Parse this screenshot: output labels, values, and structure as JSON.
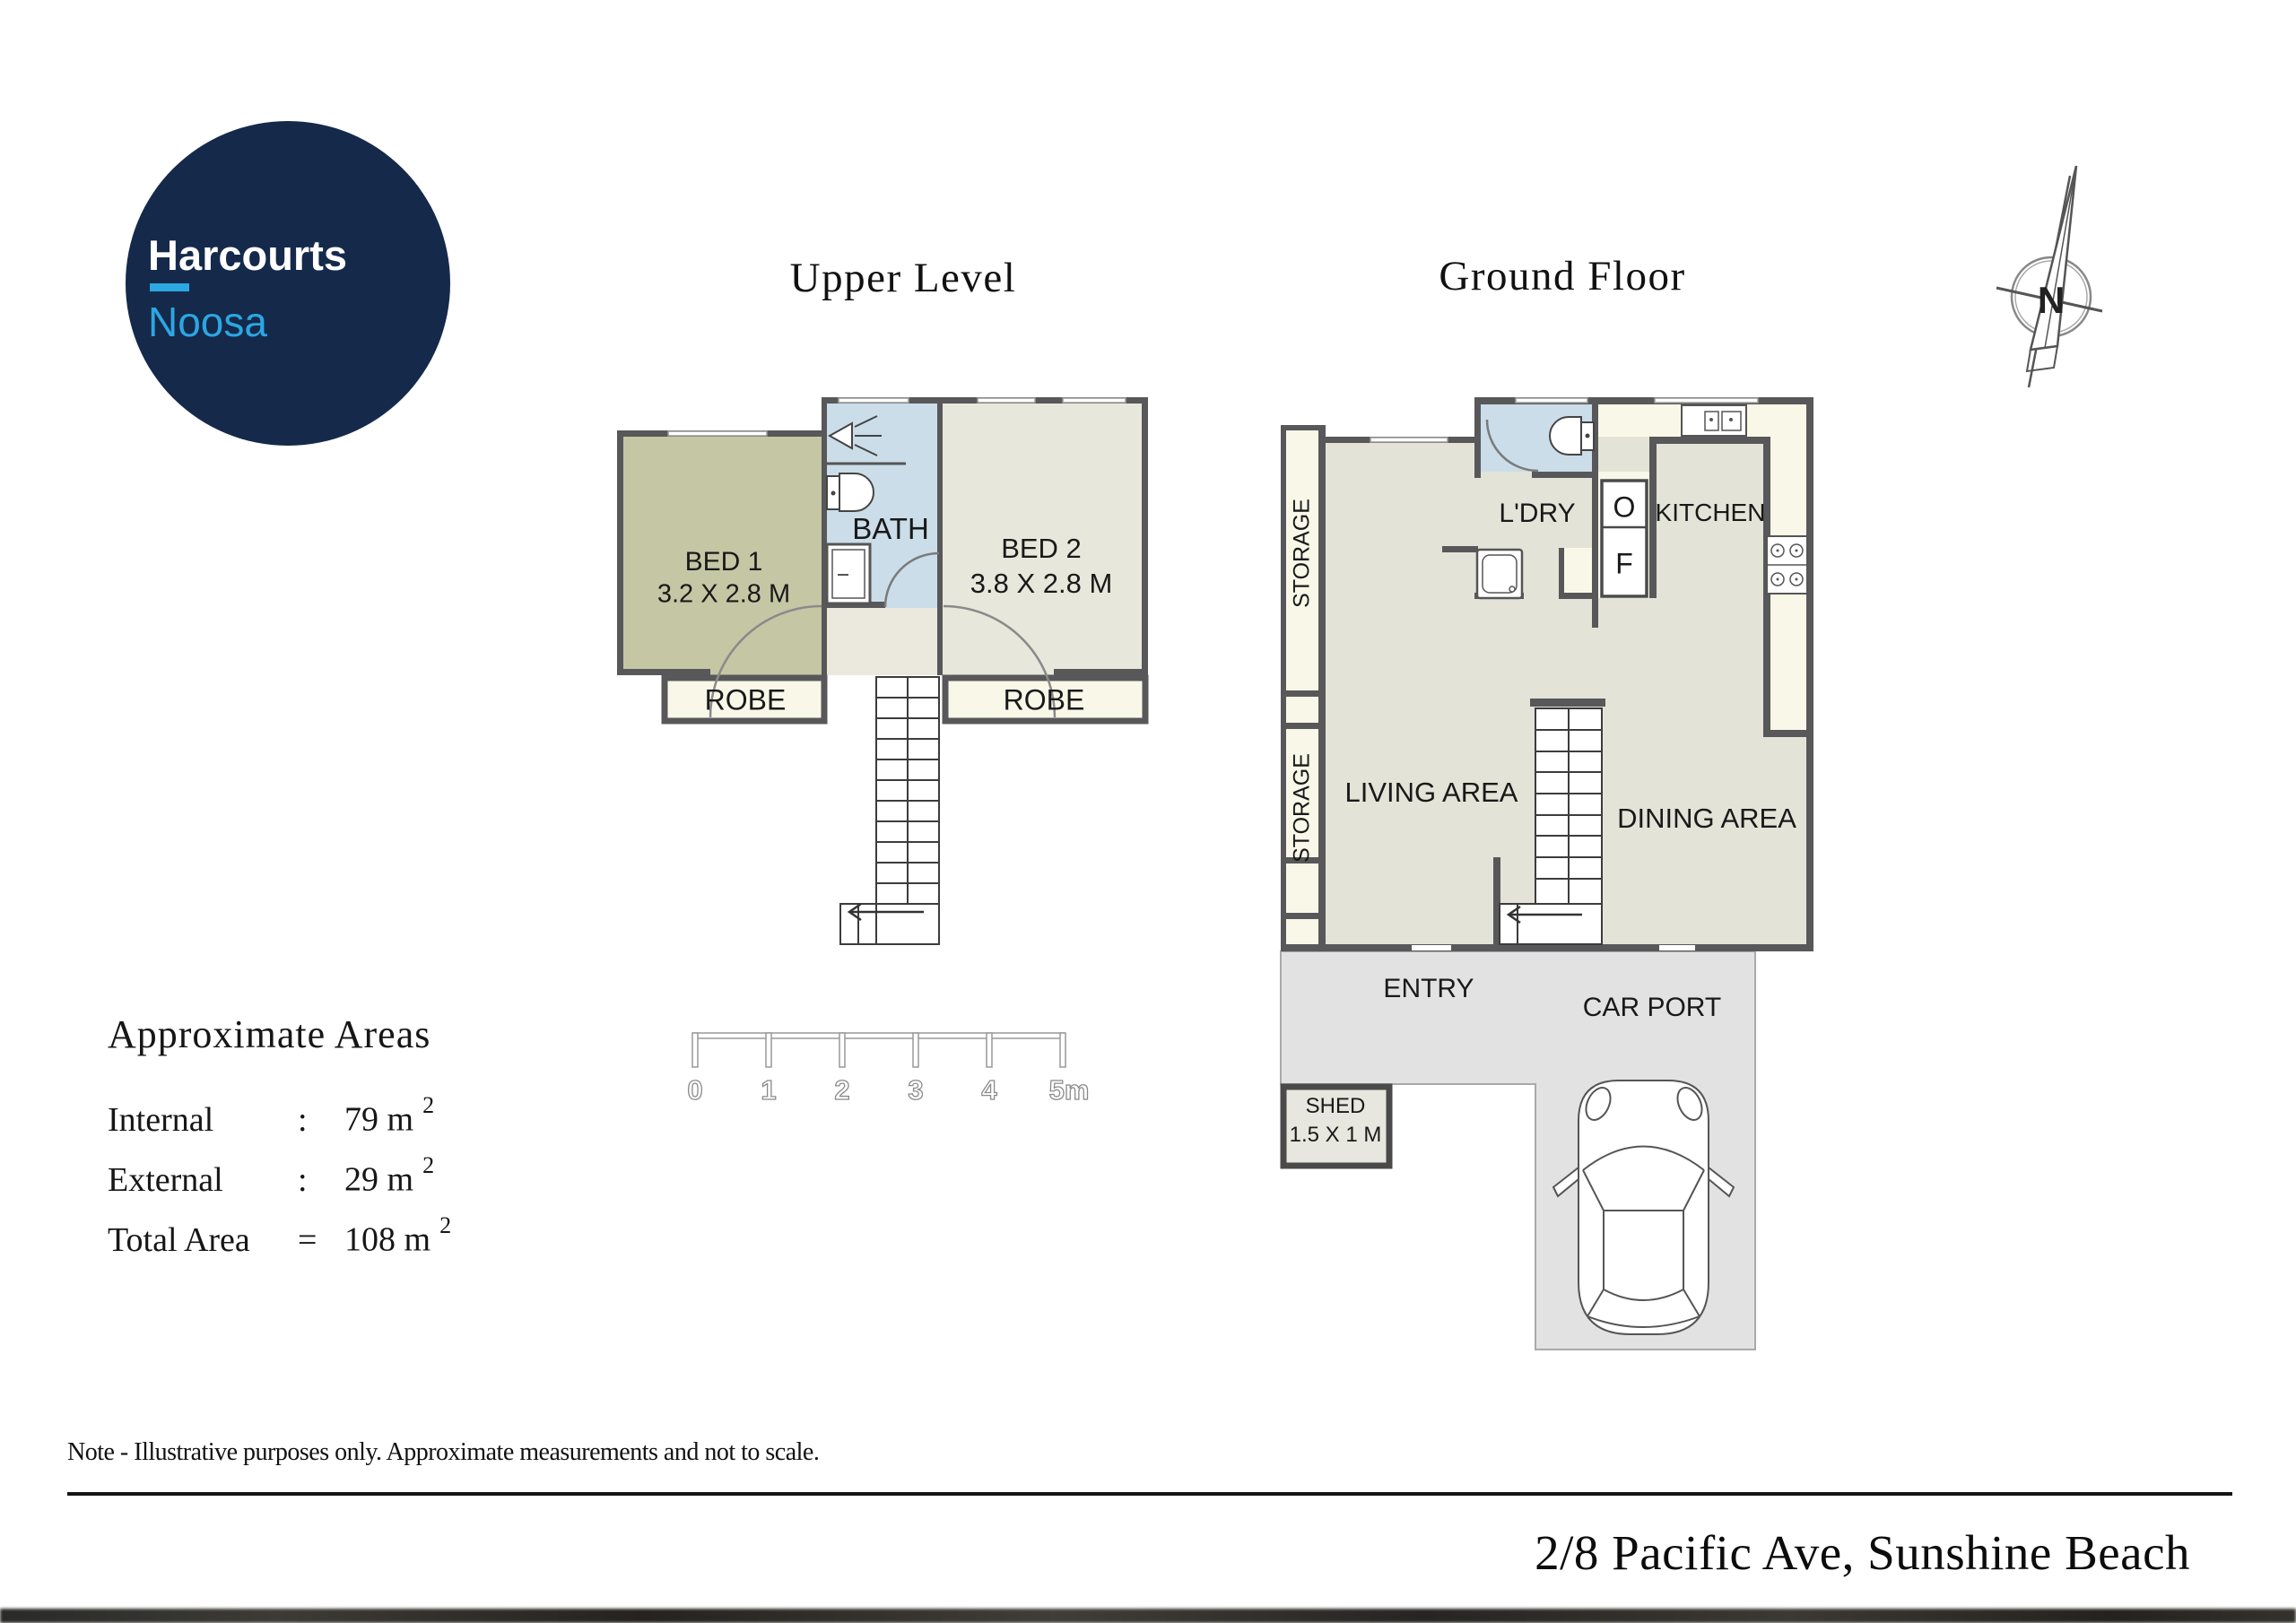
{
  "logo": {
    "brand": "Harcourts",
    "office": "Noosa",
    "navy": "#15294b",
    "light_blue": "#2ba7e2"
  },
  "titles": {
    "upper": "Upper Level",
    "ground": "Ground Floor"
  },
  "compass": {
    "label": "N"
  },
  "upper_level": {
    "bed1": {
      "name": "BED 1",
      "dims": "3.2 X 2.8 M"
    },
    "bath": {
      "name": "BATH"
    },
    "bed2": {
      "name": "BED 2",
      "dims": "3.8 X 2.8 M"
    },
    "robe_left": "ROBE",
    "robe_right": "ROBE"
  },
  "ground_floor": {
    "storage_upper": "STORAGE",
    "storage_lower": "STORAGE",
    "ldry": "L'DRY",
    "oven": "O",
    "fridge": "F",
    "kitchen": "KITCHEN",
    "living": "LIVING AREA",
    "dining": "DINING AREA",
    "entry": "ENTRY",
    "carport": "CAR PORT",
    "shed_line1": "SHED",
    "shed_line2": "1.5 X 1 M"
  },
  "scale_bar": {
    "labels": [
      "0",
      "1",
      "2",
      "3",
      "4",
      "5m"
    ]
  },
  "areas": {
    "heading": "Approximate Areas",
    "rows": [
      {
        "label": "Internal",
        "sep": ":",
        "value": "79 m",
        "sup": "2"
      },
      {
        "label": "External",
        "sep": ":",
        "value": "29 m",
        "sup": "2"
      },
      {
        "label": "Total Area",
        "sep": "=",
        "value": "108 m",
        "sup": "2"
      }
    ]
  },
  "note": "Note - Illustrative purposes only. Approximate measurements and not to scale.",
  "address": "2/8  Pacific Ave, Sunshine Beach",
  "colors": {
    "wall": "#58585a",
    "bed1_floor": "#c5c6a4",
    "bath_floor": "#cadde9",
    "bed2_floor": "#e7e7db",
    "cream": "#f9f8e8",
    "floor_gray_green": "#e3e3d8",
    "landing": "#ebe9de",
    "outdoor_gray": "#e2e2e2",
    "shed_fill": "#e7e7df"
  }
}
